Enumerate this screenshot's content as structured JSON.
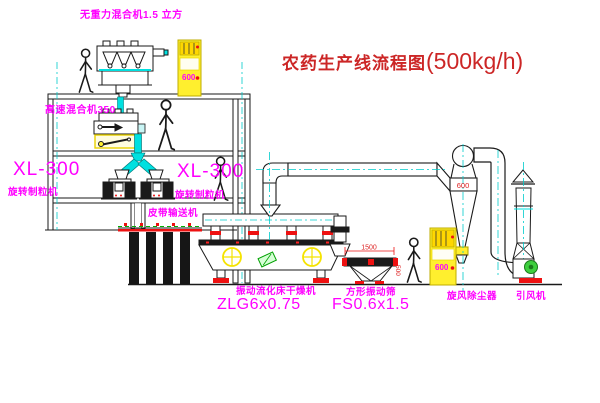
{
  "title": {
    "name": "农药生产线流程图",
    "capacity": "(500kg/h)"
  },
  "labels": {
    "gravity_mixer": "无重力混合机1.5 立方",
    "high_speed_mixer": "高速混合机350",
    "granulator_left_model": "XL-300",
    "granulator_left_name": "旋转制粒机",
    "granulator_right_model": "XL-300",
    "granulator_right_name": "旋转制粒机",
    "belt_conveyor": "皮带输送机",
    "dryer_name": "振动流化床干燥机",
    "dryer_model": "ZLG6x0.75",
    "sieve_name": "方形振动筛",
    "sieve_model": "FS0.6x1.5",
    "cyclone": "旋风除尘器",
    "fan": "引风机"
  },
  "annotations": {
    "cyclone_dia": "600",
    "sieve_length": "1500",
    "sieve_height": "500",
    "cabinet1_text": "600",
    "cabinet2_text": "600"
  },
  "colors": {
    "label_magenta": "#ff00ff",
    "title_red": "#cc2626",
    "line_black": "#1a1a1a",
    "pipe_cyan": "#00e0e0",
    "equipment_yellow": "#ffef2e",
    "accent_red": "#ee1111",
    "motor_green": "#3ecf3e"
  }
}
